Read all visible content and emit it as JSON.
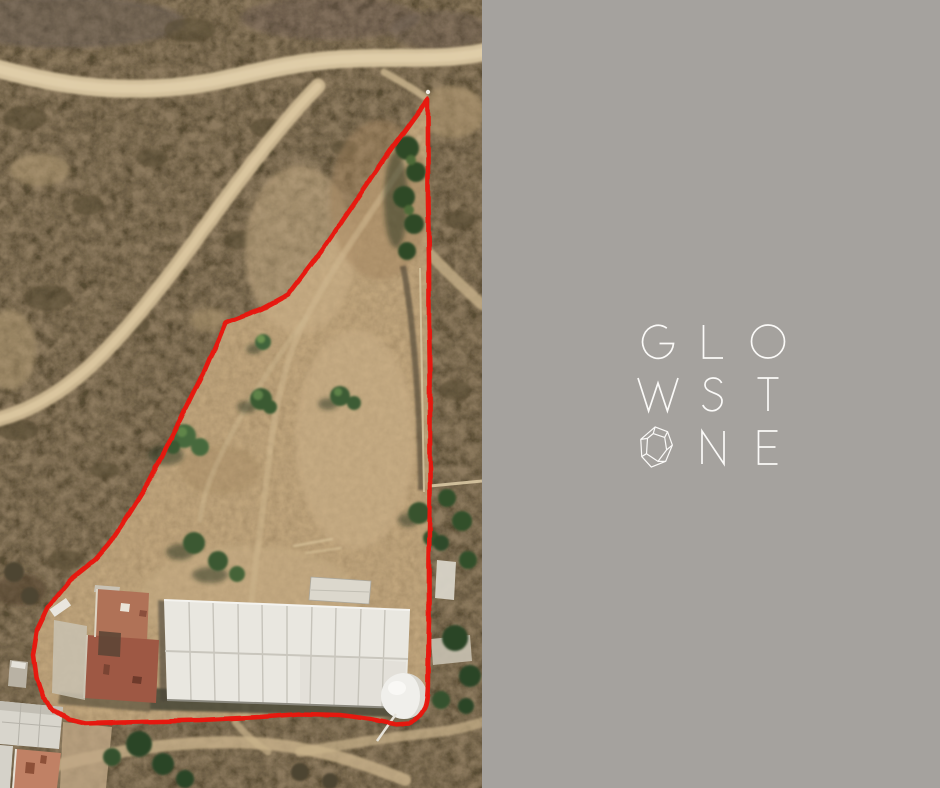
{
  "left_panel": {
    "type": "satellite-photo",
    "boundary_color": "#e8190a",
    "features": [
      "red-property-boundary",
      "dirt-roads",
      "scrubland",
      "trees",
      "warehouse-building-white-roof",
      "house-terracotta-roof",
      "white-dome-tank"
    ]
  },
  "right_panel": {
    "background": "#a5a29e",
    "logo": {
      "brand": "GLOWSTONE",
      "color": "#fbfaf8",
      "rows": [
        {
          "chars": "GLO"
        },
        {
          "chars": "WST"
        },
        {
          "icon": "stone-icon",
          "chars": "NE"
        }
      ]
    }
  }
}
